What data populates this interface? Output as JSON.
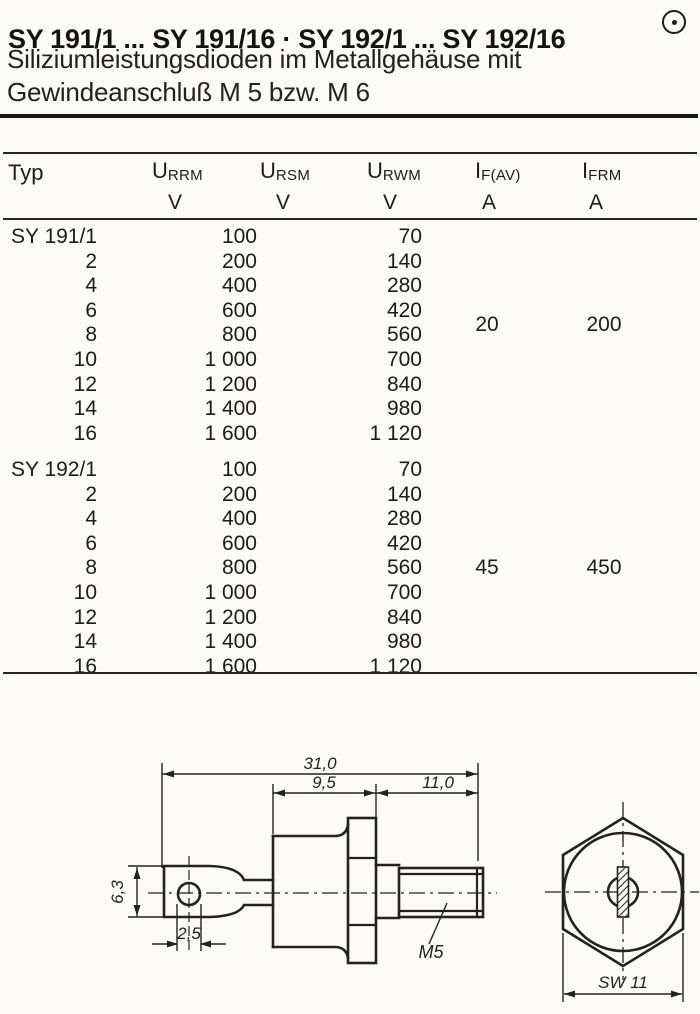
{
  "colors": {
    "ink": "#1d1c1a",
    "paper": "#fbfaf6"
  },
  "header": {
    "title": "SY 191/1 ... SY 191/16 · SY 192/1 ... SY 192/16",
    "subtitle_line1": "Siliziumleistungsdioden im Metallgehäuse mit",
    "subtitle_line2": "Gewindeanschluß M 5 bzw. M 6",
    "mark_icon": "circled-dot"
  },
  "table": {
    "typ_label": "Typ",
    "columns": [
      {
        "sym": "U",
        "sub": "RRM",
        "unit": "V"
      },
      {
        "sym": "U",
        "sub": "RSM",
        "unit": "V"
      },
      {
        "sym": "U",
        "sub": "RWM",
        "unit": "V"
      },
      {
        "sym": "I",
        "sub": "F(AV)",
        "unit": "A"
      },
      {
        "sym": "I",
        "sub": "FRM",
        "unit": "A"
      }
    ],
    "groups": [
      {
        "if_av": "20",
        "ifrm": "200",
        "rows": [
          {
            "typ": "SY 191/1",
            "urrm": "100",
            "urwm": "70"
          },
          {
            "typ": "2",
            "urrm": "200",
            "urwm": "140"
          },
          {
            "typ": "4",
            "urrm": "400",
            "urwm": "280"
          },
          {
            "typ": "6",
            "urrm": "600",
            "urwm": "420"
          },
          {
            "typ": "8",
            "urrm": "800",
            "urwm": "560"
          },
          {
            "typ": "10",
            "urrm": "1 000",
            "urwm": "700"
          },
          {
            "typ": "12",
            "urrm": "1 200",
            "urwm": "840"
          },
          {
            "typ": "14",
            "urrm": "1 400",
            "urwm": "980"
          },
          {
            "typ": "16",
            "urrm": "1 600",
            "urwm": "1 120"
          }
        ]
      },
      {
        "if_av": "45",
        "ifrm": "450",
        "rows": [
          {
            "typ": "SY 192/1",
            "urrm": "100",
            "urwm": "70"
          },
          {
            "typ": "2",
            "urrm": "200",
            "urwm": "140"
          },
          {
            "typ": "4",
            "urrm": "400",
            "urwm": "280"
          },
          {
            "typ": "6",
            "urrm": "600",
            "urwm": "420"
          },
          {
            "typ": "8",
            "urrm": "800",
            "urwm": "560"
          },
          {
            "typ": "10",
            "urrm": "1 000",
            "urwm": "700"
          },
          {
            "typ": "12",
            "urrm": "1 200",
            "urwm": "840"
          },
          {
            "typ": "14",
            "urrm": "1 400",
            "urwm": "980"
          },
          {
            "typ": "16",
            "urrm": "1 600",
            "urwm": "1 120"
          }
        ]
      }
    ]
  },
  "drawing": {
    "side_view": {
      "dim_total": "31,0",
      "dim_body": "9,5",
      "dim_stud": "11,0",
      "dim_lug_height": "6,3",
      "dim_hole": "2,5",
      "thread_label": "M5"
    },
    "end_view": {
      "wrench_size_label": "SW 11"
    }
  }
}
